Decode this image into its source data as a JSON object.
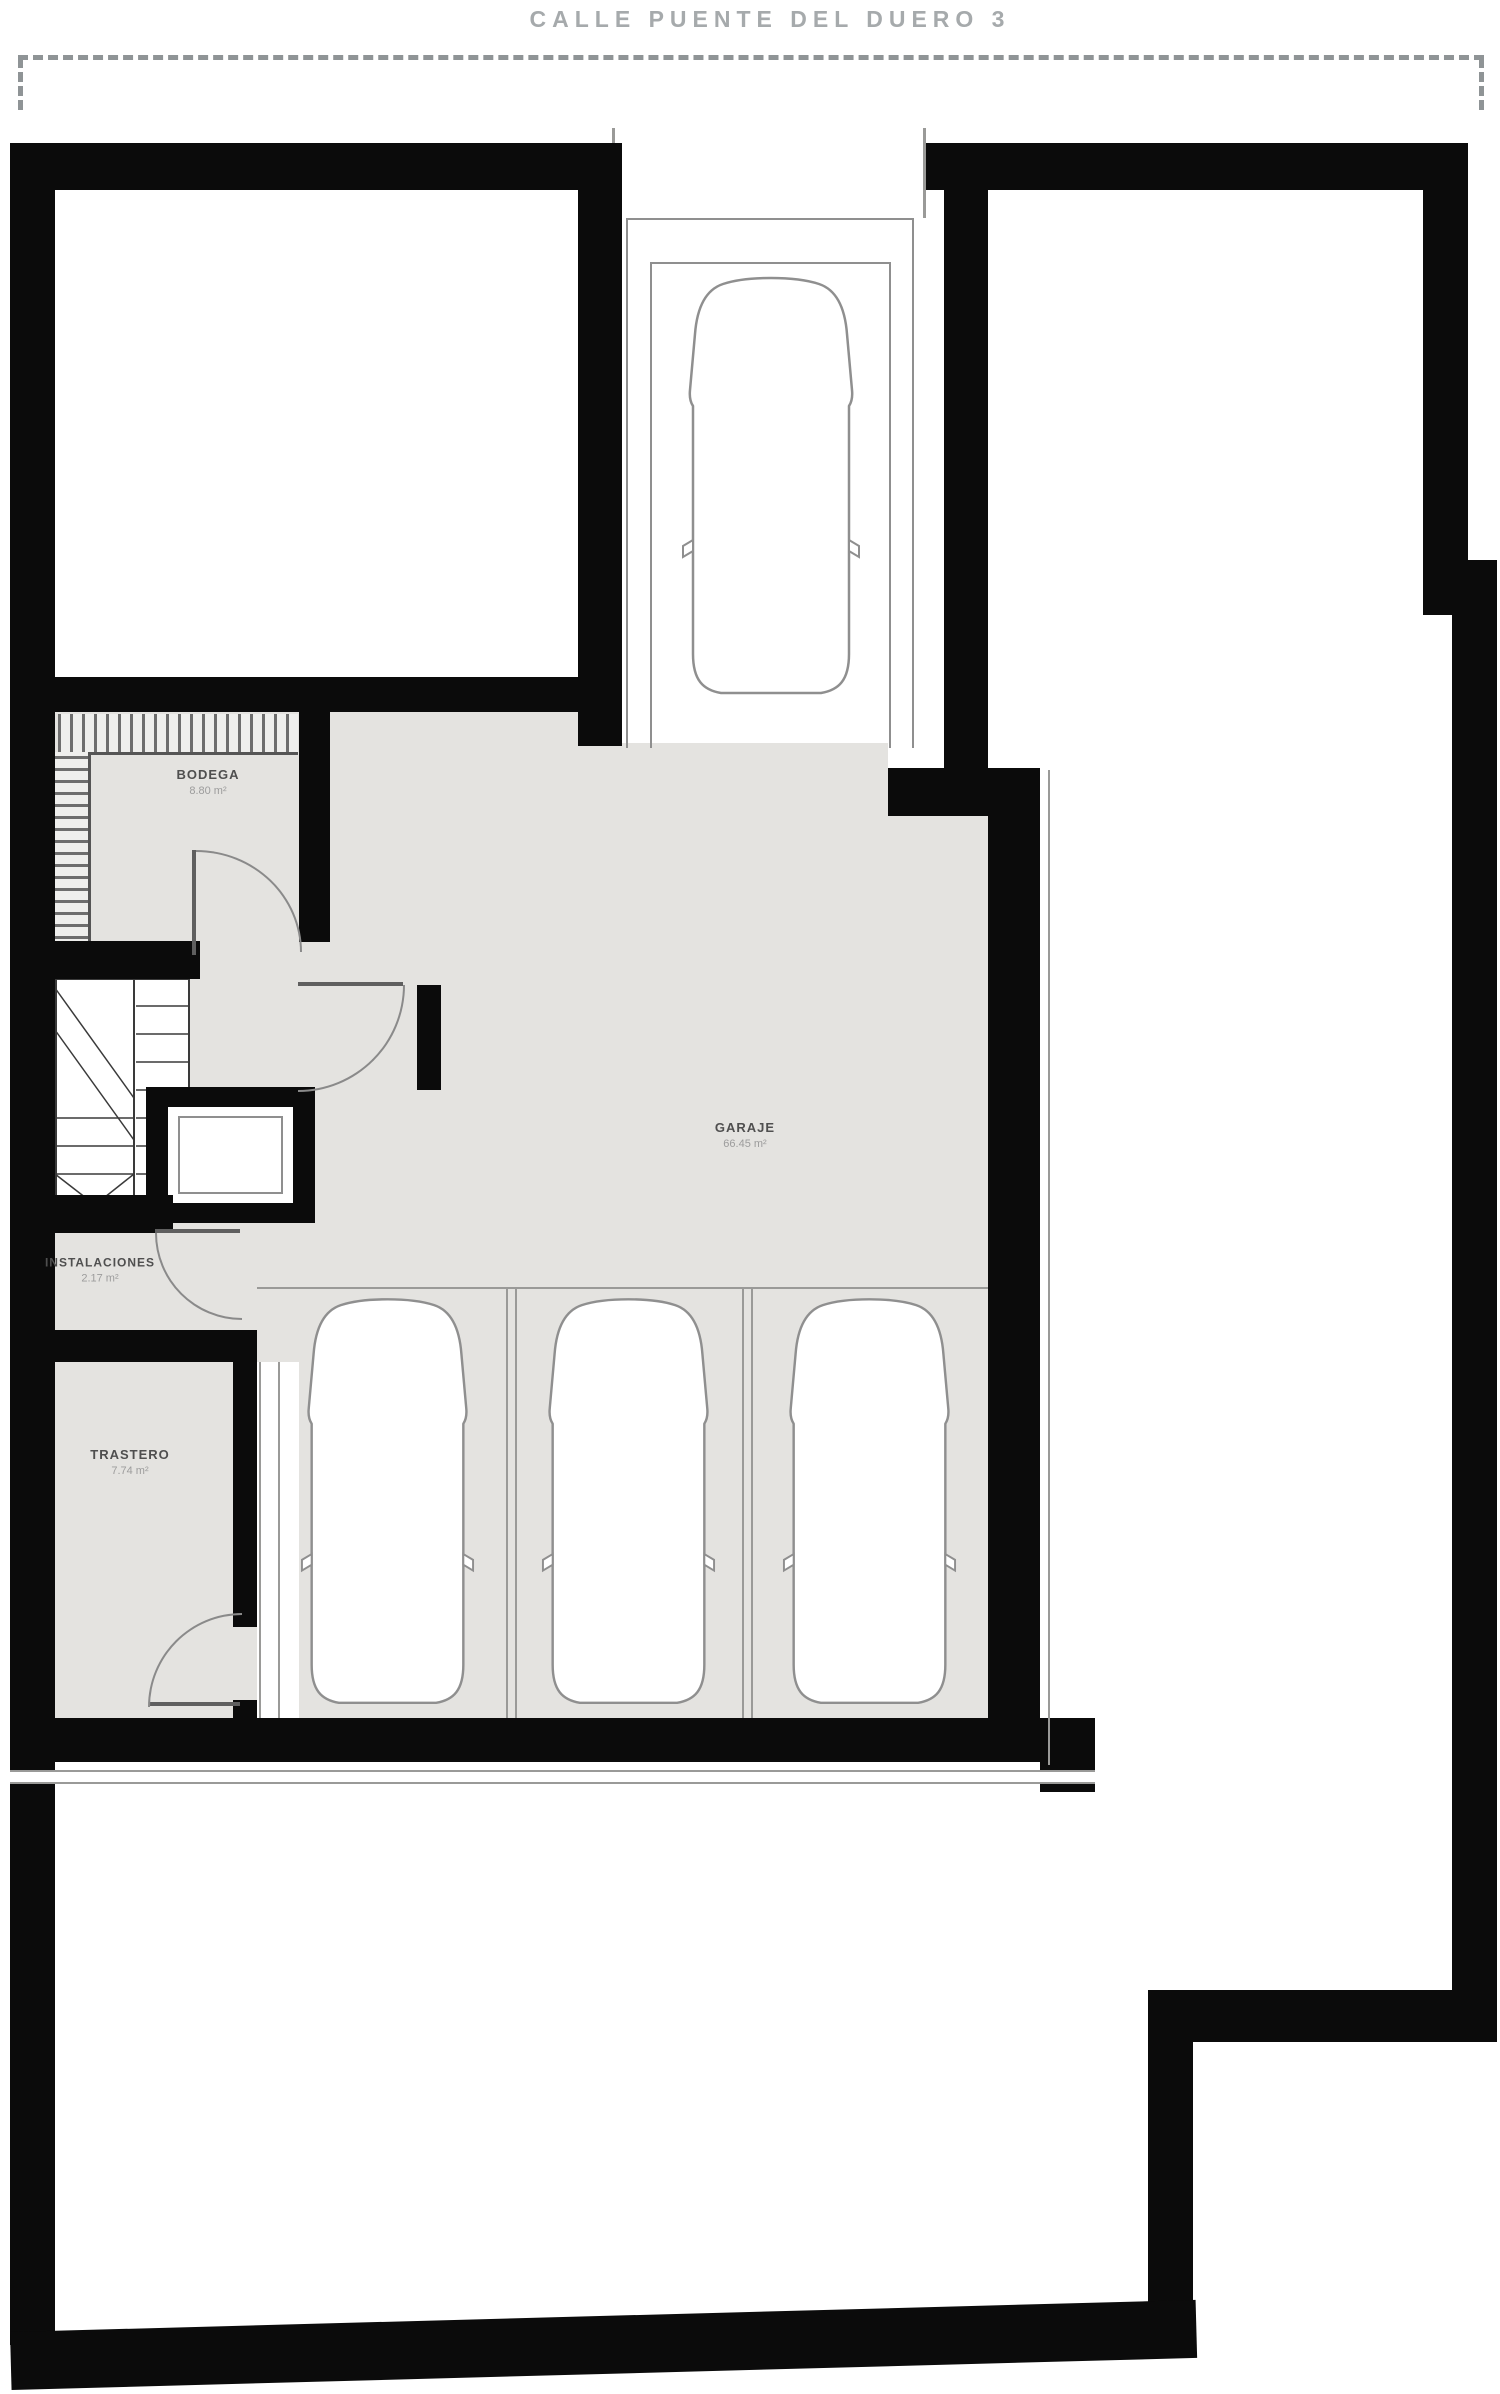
{
  "title": "CALLE PUENTE DEL DUERO 3",
  "plan": {
    "type": "basement-garage-floor-plan",
    "rooms": {
      "bodega": {
        "name": "BODEGA",
        "area": "8.80 m²"
      },
      "garaje": {
        "name": "GARAJE",
        "area": "66.45 m²"
      },
      "instalaciones": {
        "name": "INSTALACIONES",
        "area": "2.17 m²"
      },
      "trastero": {
        "name": "TRASTERO",
        "area": "7.74 m²"
      }
    },
    "features": {
      "cars": 4,
      "parking_bays": 3,
      "stairs": true,
      "elevator": true,
      "ramp": true,
      "wardrobe_hatch": true,
      "doors": 4
    },
    "colors": {
      "wall": "#0b0b0b",
      "floor": "#e4e3e0",
      "outline": "#8f8f8f",
      "boundary_dash": "#8f9496",
      "title_text": "#a6aaac",
      "room_name_text": "#4f4f4f",
      "room_area_text": "#9c9c9c"
    }
  }
}
